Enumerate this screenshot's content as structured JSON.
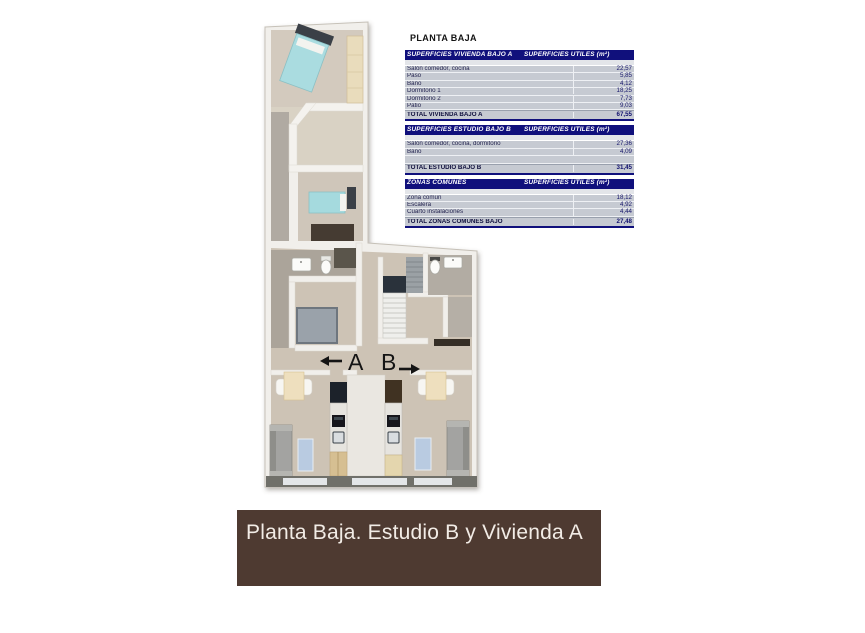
{
  "plan": {
    "label_a": "A",
    "label_b": "B"
  },
  "panel": {
    "title": "PLANTA BAJA",
    "tables": [
      {
        "header_left": "SUPERFICIES VIVIENDA BAJO A",
        "header_right": "SUPERFICIES UTILES  (m²)",
        "rows": [
          {
            "label": "Salón comedor, cocina",
            "value": "22,57"
          },
          {
            "label": "Paso",
            "value": "5,85"
          },
          {
            "label": "Baño",
            "value": "4,12"
          },
          {
            "label": "Dormitorio 1",
            "value": "18,25"
          },
          {
            "label": "Dormitorio 2",
            "value": "7,73"
          },
          {
            "label": "Patio",
            "value": "9,03"
          }
        ],
        "total_label": "TOTAL VIVIENDA BAJO A",
        "total_value": "67,55"
      },
      {
        "header_left": "SUPERFICIES ESTUDIO BAJO B",
        "header_right": "SUPERFICIES UTILES  (m²)",
        "rows": [
          {
            "label": "Salón comedor, cocina, dormitorio",
            "value": "27,36"
          },
          {
            "label": "Baño",
            "value": "4,09"
          },
          {
            "label": "",
            "value": ""
          }
        ],
        "total_label": "TOTAL ESTUDIO BAJO B",
        "total_value": "31,45"
      },
      {
        "header_left": "ZONAS COMUNES",
        "header_right": "SUPERFICIES UTILES  (m²)",
        "rows": [
          {
            "label": "Zona común",
            "value": "18,12"
          },
          {
            "label": "Escalera",
            "value": "4,92"
          },
          {
            "label": "Cuarto instalaciones",
            "value": "4,44"
          }
        ],
        "total_label": "TOTAL ZONAS COMUNES BAJO",
        "total_value": "27,48"
      }
    ]
  },
  "banner": {
    "text": "Planta Baja. Estudio B y Vivienda A"
  },
  "colors": {
    "table_header_bg": "#10107c",
    "table_row_bg": "#c6cad2",
    "table_value_text": "#17176b",
    "banner_bg": "#4e3a31",
    "banner_text": "#f2ece6",
    "bed": "#aadce0",
    "rug": "#b9cbe1",
    "floor": "#cfc6b8",
    "wall": "#f1efeb"
  }
}
